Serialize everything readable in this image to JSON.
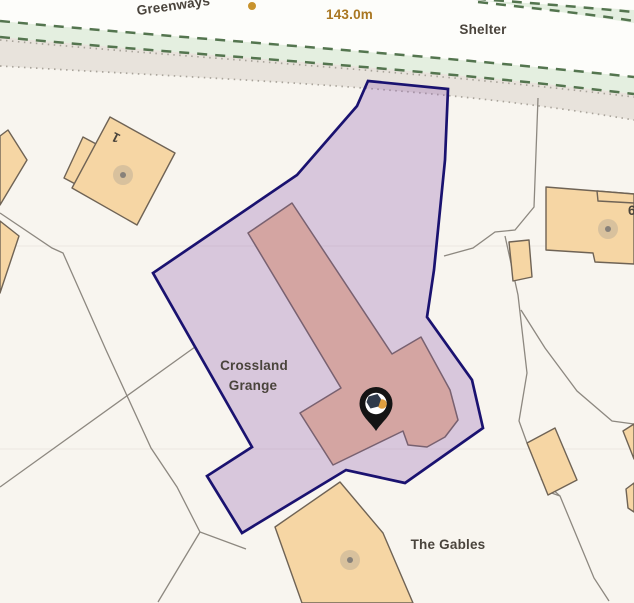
{
  "map_labels": {
    "road_name": "Greenways",
    "spot_height": "143.0m",
    "shelter": "Shelter",
    "property_line1": "Crossland",
    "property_line2": "Grange",
    "neighbor": "The Gables",
    "house_number": "1",
    "house_number_partial": "6"
  },
  "marker": {
    "icon": "map-pin",
    "description": "black location pin with white circle and navy-orange logo"
  },
  "colors": {
    "parcel_fill": "rgba(141,94,176,0.30)",
    "parcel_stroke": "#1a1270",
    "building_fill": "#f6d6a4",
    "building_stroke": "#6f6355",
    "highlighted_building_fill": "#f3c49c",
    "road_fill": "#e8e3dc",
    "path_green_fill": "#e4efe0",
    "path_dash_green": "#54754f",
    "label_text": "#4a443c",
    "spot_height_text": "#a97722",
    "spot_height_dot": "#c8932d",
    "pin_black": "#141414",
    "pin_orange": "#e09f3e",
    "pin_navy": "#2f3a4a",
    "background": "#f8f5ef"
  }
}
